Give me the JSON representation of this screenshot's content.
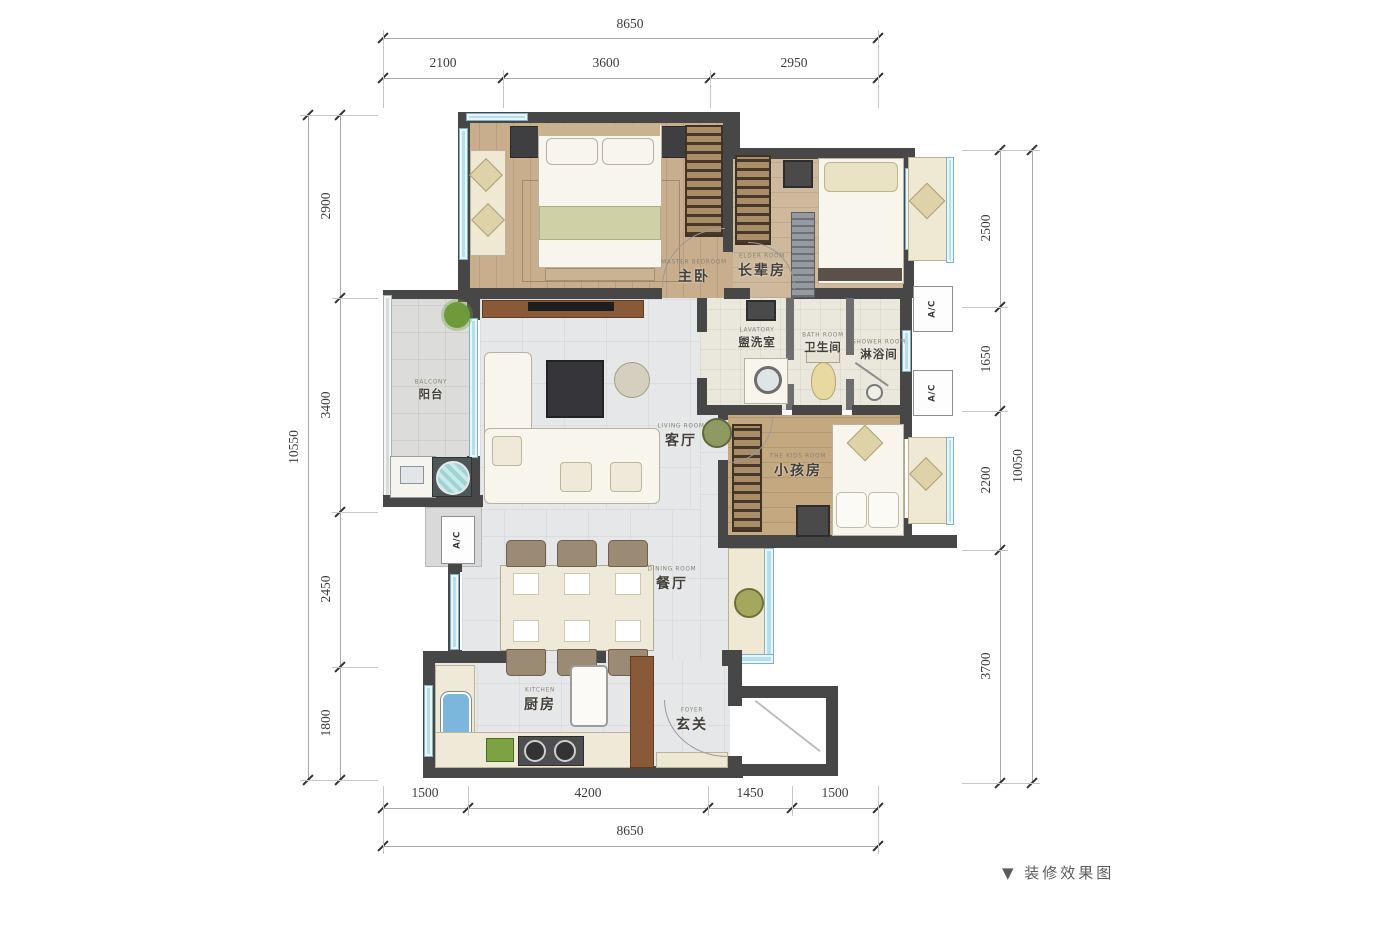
{
  "caption": "▼ 装修效果图",
  "dimensions": {
    "top": {
      "total": "8650",
      "segments": [
        "2100",
        "3600",
        "2950"
      ]
    },
    "bottom": {
      "total": "8650",
      "segments": [
        "1500",
        "4200",
        "1450",
        "1500"
      ]
    },
    "left": {
      "total": "10550",
      "segments": [
        "2900",
        "3400",
        "2450",
        "1800"
      ]
    },
    "right": {
      "total": "10050",
      "segments": [
        "2500",
        "1650",
        "2200",
        "3700"
      ]
    }
  },
  "rooms": {
    "master": {
      "cn": "主卧",
      "en": "MASTER BEDROOM"
    },
    "elder": {
      "cn": "长辈房",
      "en": "ELDER ROOM"
    },
    "lavatory": {
      "cn": "盥洗室",
      "en": "LAVATORY"
    },
    "bathroom": {
      "cn": "卫生间",
      "en": "BATH ROOM"
    },
    "shower": {
      "cn": "淋浴间",
      "en": "SHOWER ROOM"
    },
    "balcony": {
      "cn": "阳台",
      "en": "BALCONY"
    },
    "living": {
      "cn": "客厅",
      "en": "LIVING ROOM"
    },
    "kids": {
      "cn": "小孩房",
      "en": "THE KIDS ROOM"
    },
    "dining": {
      "cn": "餐厅",
      "en": "DINING ROOM"
    },
    "kitchen": {
      "cn": "厨房",
      "en": "KITCHEN"
    },
    "foyer": {
      "cn": "玄关",
      "en": "FOYER"
    }
  },
  "tags": {
    "ac": "A/C"
  },
  "colors": {
    "wall": "#474747",
    "window_blue": "#b7deea",
    "wood_floor": "#c8ae8d",
    "tile_floor": "#e6e7e9",
    "dim_text": "#3c3c3c"
  }
}
